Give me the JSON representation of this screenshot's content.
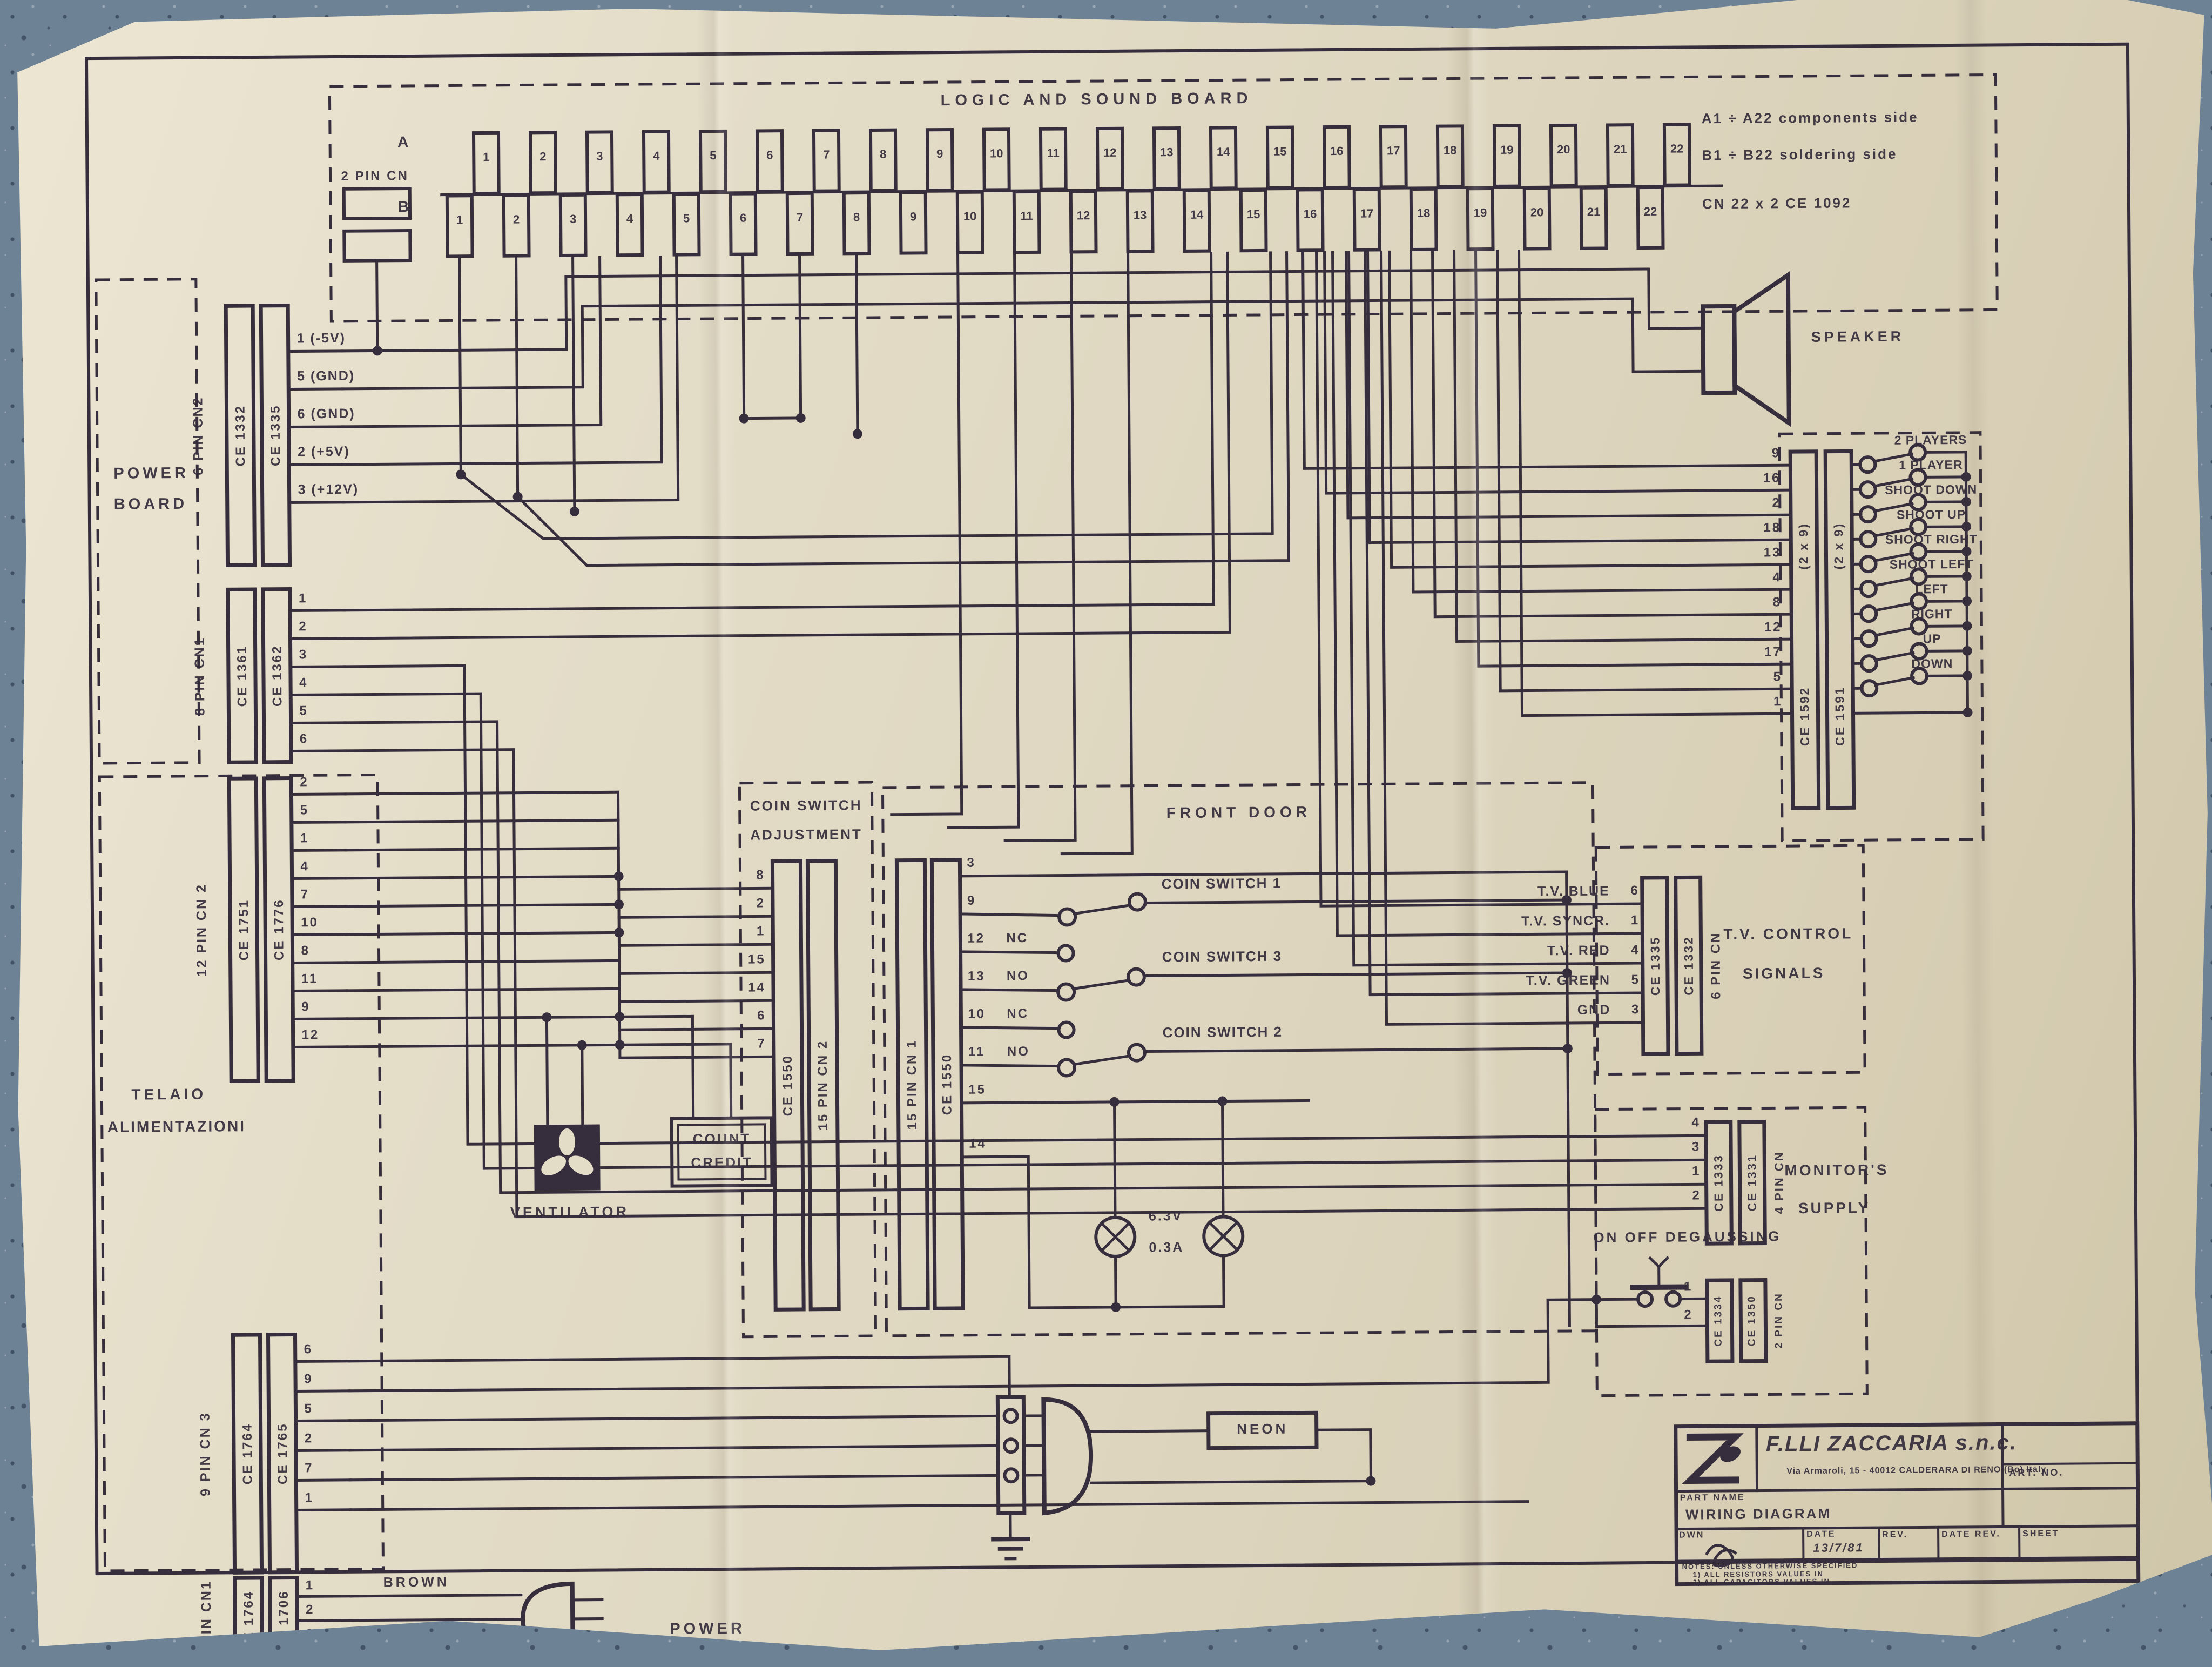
{
  "board": {
    "title": "LOGIC AND SOUND BOARD",
    "side_a": "A",
    "side_b": "B",
    "legend": [
      "A1 ÷ A22   components side",
      "B1 ÷ B22   soldering side",
      "CN 22 x 2      CE 1092"
    ],
    "pins_a": [
      "1",
      "2",
      "3",
      "4",
      "5",
      "6",
      "7",
      "8",
      "9",
      "10",
      "11",
      "12",
      "13",
      "14",
      "15",
      "16",
      "17",
      "18",
      "19",
      "20",
      "21",
      "22"
    ],
    "pins_b": [
      "1",
      "2",
      "3",
      "4",
      "5",
      "6",
      "7",
      "8",
      "9",
      "10",
      "11",
      "12",
      "13",
      "14",
      "15",
      "16",
      "17",
      "18",
      "19",
      "20",
      "21",
      "22"
    ]
  },
  "two_pin_cn": {
    "label": "2 PIN CN"
  },
  "speaker": {
    "label": "SPEAKER"
  },
  "sections": {
    "power_board": {
      "line1": "POWER",
      "line2": "BOARD"
    },
    "telaio": {
      "line1": "TELAIO",
      "line2": "ALIMENTAZIONI"
    },
    "coin": {
      "line1": "COIN SWITCH",
      "line2": "ADJUSTMENT"
    },
    "front_door": {
      "label": "FRONT DOOR"
    },
    "tv": {
      "line1": "T.V. CONTROL",
      "line2": "SIGNALS"
    },
    "monitor": {
      "line1": "MONITOR'S",
      "line2": "SUPPLY"
    }
  },
  "connectors": {
    "cn2_6": {
      "name": "6 PIN CN2",
      "ce1": "CE 1332",
      "ce2": "CE 1335",
      "pins": [
        "1 (-5V)",
        "5 (GND)",
        "6 (GND)",
        "2 (+5V)",
        "3 (+12V)"
      ]
    },
    "cn1_8": {
      "name": "8 PIN CN1",
      "ce1": "CE 1361",
      "ce2": "CE 1362",
      "pins": [
        "1",
        "2",
        "3",
        "4",
        "5",
        "6"
      ]
    },
    "cn2_12": {
      "name": "12 PIN CN 2",
      "ce1": "CE 1751",
      "ce2": "CE 1776",
      "pins": [
        "2",
        "5",
        "1",
        "4",
        "7",
        "10",
        "8",
        "11",
        "9",
        "12"
      ]
    },
    "cn3_9": {
      "name": "9 PIN CN 3",
      "ce1": "CE 1764",
      "ce2": "CE 1765",
      "pins": [
        "6",
        "9",
        "5",
        "2",
        "7",
        "1"
      ]
    },
    "cn1_3": {
      "name": "3 PIN CN1",
      "ce1": "CE 1764",
      "ce2": "CE 1706",
      "pins": [
        "1",
        "2",
        "3"
      ]
    },
    "coin_left": {
      "ce": "CE 1550",
      "name": "15 PIN CN 2",
      "pins": [
        "8",
        "2",
        "1",
        "15",
        "14",
        "6",
        "7"
      ]
    },
    "coin_right": {
      "name": "15 PIN CN 1",
      "ce": "CE 1550",
      "pins": [
        "3",
        "9",
        "12",
        "13",
        "10",
        "11",
        "15",
        "14"
      ],
      "contacts": [
        "",
        "",
        "NC",
        "NO",
        "NC",
        "NO",
        "",
        ""
      ]
    },
    "controls_left": {
      "ce": "CE 1592",
      "sub": "(2 x 9)"
    },
    "controls_right": {
      "ce": "CE 1591",
      "sub": "(2 x 9)",
      "pins": [
        "9",
        "16",
        "2",
        "18",
        "13",
        "4",
        "8",
        "12",
        "17",
        "5",
        "1"
      ]
    },
    "tv": {
      "ce1": "CE 1335",
      "ce2": "CE 1332",
      "name": "6 PIN CN",
      "pins": [
        "6",
        "1",
        "4",
        "5",
        "3"
      ]
    },
    "monitor": {
      "ce1": "CE 1333",
      "ce2": "CE 1331",
      "name": "4 PIN CN",
      "pins": [
        "4",
        "3",
        "1",
        "2"
      ]
    },
    "degauss": {
      "ce1": "CE 1334",
      "ce2": "CE 1350",
      "name": "2 PIN CN",
      "pins": [
        "1",
        "2"
      ]
    }
  },
  "controls": {
    "switches": [
      "2 PLAYERS",
      "1 PLAYER",
      "SHOOT DOWN",
      "SHOOT UP",
      "SHOOT RIGHT",
      "SHOOT LEFT",
      "LEFT",
      "RIGHT",
      "UP",
      "DOWN"
    ]
  },
  "coin": {
    "switches": [
      "COIN SWITCH 1",
      "COIN SWITCH 3",
      "COIN SWITCH 2"
    ],
    "lamp_v": "6.3V",
    "lamp_a": "0.3A"
  },
  "tv_signals": [
    "T.V.  BLUE",
    "T.V.  SYNCR.",
    "T.V.  RED",
    "T.V.  GREEN",
    "GND"
  ],
  "degauss_label": "ON OFF  DEGAUSSING",
  "wire_labels": {
    "brown": "BROWN",
    "light_blue": "LIGHT BLUE",
    "power": "POWER",
    "neon": "NEON",
    "ventilator": "VENTILATOR",
    "count_1": "COUNT",
    "count_2": "CREDIT"
  },
  "title_block": {
    "company": "F.LLI ZACCARIA s.n.c.",
    "address": "Via Armaroli, 15 - 40012 CALDERARA DI RENO (Bo) Italy",
    "part_name_label": "PART NAME",
    "part_name": "WIRING DIAGRAM",
    "art_no": "ART. NO.",
    "dwn": "DWN",
    "date_label": "DATE",
    "date": "13/7/81",
    "rev": "REV.",
    "date_rev": "DATE REV.",
    "sheet": "SHEET",
    "notes": [
      "NOTES: UNLESS OTHERWISE SPECIFIED",
      "1) ALL RESISTORS VALUES IN",
      "2) ALL CAPACITORS VALUES IN"
    ]
  }
}
